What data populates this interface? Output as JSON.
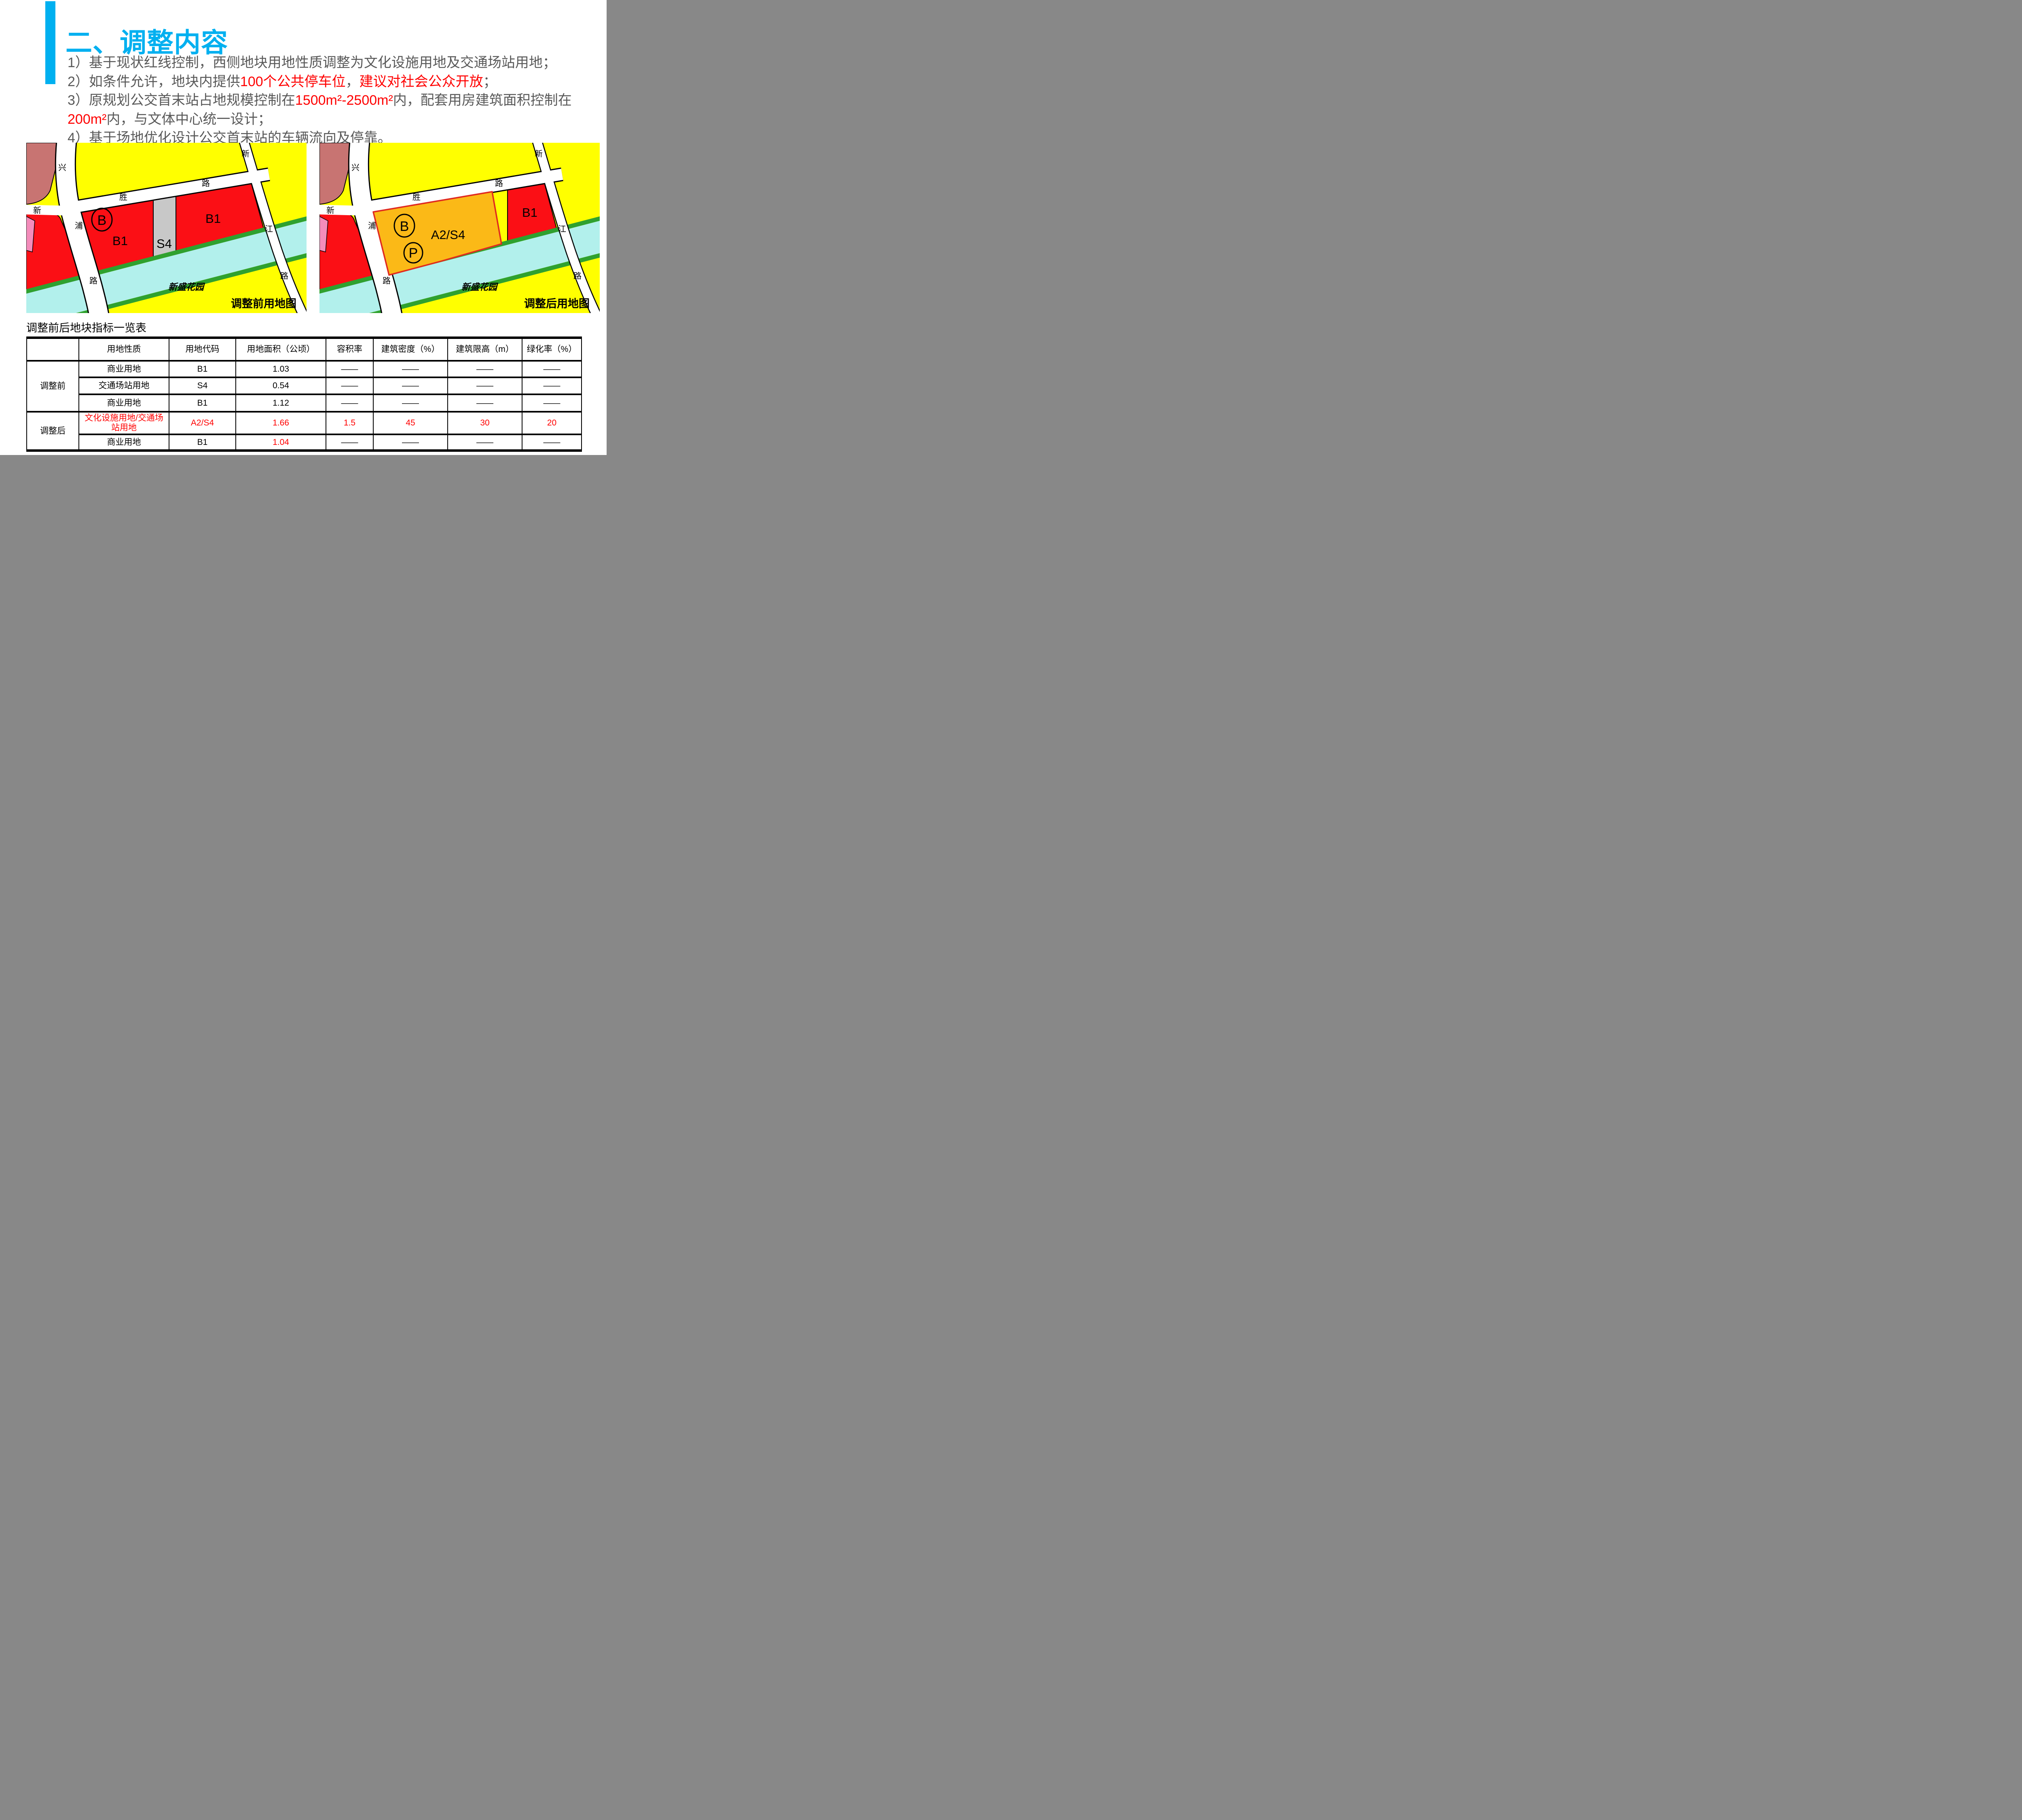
{
  "colors": {
    "accent": "#00B0F0",
    "body_text": "#595959",
    "highlight": "#FF0000",
    "map_yellow": "#FFFF00",
    "map_red": "#FB0F15",
    "map_salmon": "#C87472",
    "map_pink": "#F48CBB",
    "map_gray": "#C8C8C8",
    "map_cyan": "#B2F0EC",
    "map_green": "#2FA12F",
    "map_orange": "#FBB917",
    "map_orange_border": "#E02A20"
  },
  "header": {
    "title": "二、调整内容"
  },
  "notes": [
    {
      "parts": [
        {
          "t": "1）基于现状红线控制，西侧地块用地性质调整为文化设施用地及交通场站用地；"
        }
      ]
    },
    {
      "parts": [
        {
          "t": "2）如条件允许，地块内提供"
        },
        {
          "t": "100个公共停车位"
        },
        {
          "t": "，"
        },
        {
          "t": "建议对社会公众开放"
        },
        {
          "t": "；"
        }
      ]
    },
    {
      "parts": [
        {
          "t": "3）原规划公交首末站占地规模控制在"
        },
        {
          "t": "1500m²-2500m²"
        },
        {
          "t": "内，配套用房建筑面积控制在"
        }
      ]
    },
    {
      "parts": [
        {
          "t": "200m²"
        },
        {
          "t": "内，与文体中心统一设计；"
        }
      ]
    },
    {
      "parts": [
        {
          "t": "4）基于场地优化设计公交首末站的车辆流向及停靠。"
        }
      ]
    }
  ],
  "maps": {
    "road_labels": {
      "xing": "兴",
      "xin_w": "新",
      "pu": "浦",
      "lu_w": "路",
      "sheng": "胜",
      "lu_m": "路",
      "xin_e": "新",
      "jiang": "江",
      "lu_e": "路"
    },
    "before": {
      "caption": "调整前用地图",
      "park": "新盛花园",
      "circle_b": "B",
      "block_b1_left": "B1",
      "block_s4": "S4",
      "block_b1_right": "B1"
    },
    "after": {
      "caption": "调整后用地图",
      "park": "新盛花园",
      "circle_b": "B",
      "circle_p": "P",
      "block_a2s4": "A2/S4",
      "block_b1_right": "B1"
    }
  },
  "table": {
    "title": "调整前后地块指标一览表",
    "headers": [
      "",
      "用地性质",
      "用地代码",
      "用地面积（公顷）",
      "容积率",
      "建筑密度（%）",
      "建筑限高（m）",
      "绿化率（%）"
    ],
    "group_before": "调整前",
    "group_after": "调整后",
    "rows": [
      {
        "cells": [
          "商业用地",
          "B1",
          "1.03",
          "——",
          "——",
          "——",
          "——"
        ]
      },
      {
        "cells": [
          "交通场站用地",
          "S4",
          "0.54",
          "——",
          "——",
          "——",
          "——"
        ]
      },
      {
        "cells": [
          "商业用地",
          "B1",
          "1.12",
          "——",
          "——",
          "——",
          "——"
        ]
      },
      {
        "cells": [
          "文化设施用地/交通场站用地",
          "A2/S4",
          "1.66",
          "1.5",
          "45",
          "30",
          "20"
        ]
      },
      {
        "cells": [
          "商业用地",
          "B1",
          "1.04",
          "——",
          "——",
          "——",
          "——"
        ]
      }
    ]
  }
}
